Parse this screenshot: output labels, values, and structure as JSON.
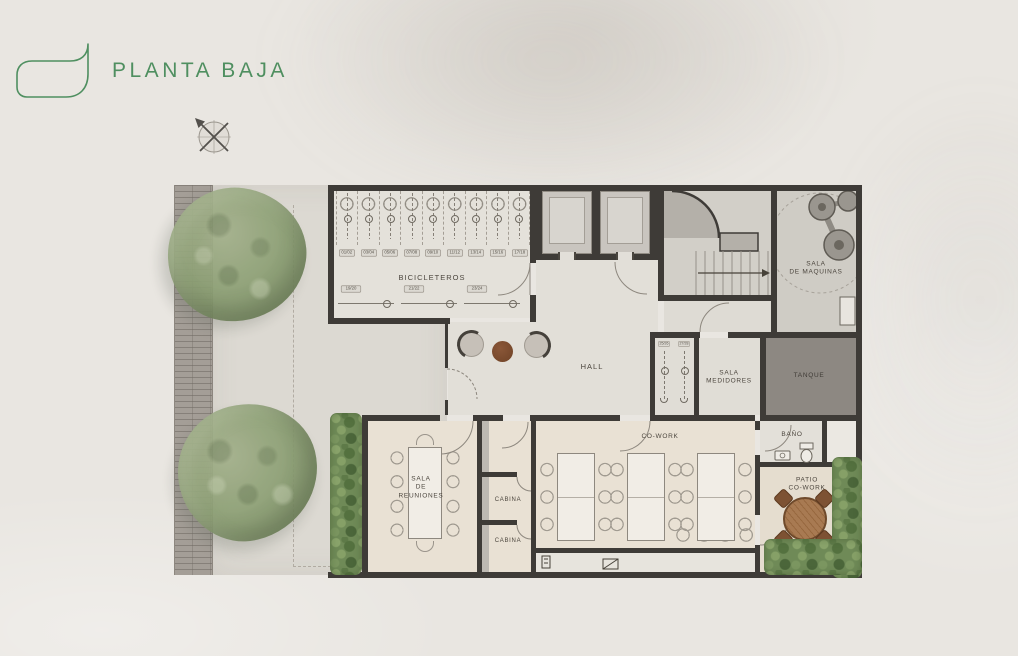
{
  "header": {
    "title": "PLANTA BAJA"
  },
  "plan": {
    "labels": {
      "bicicleteros": "BICICLETEROS",
      "hall": "HALL",
      "sala_maquinas": [
        "SALA",
        "DE MAQUINAS"
      ],
      "sala_medidores": [
        "SALA",
        "MEDIDORES"
      ],
      "tanque": "TANQUE",
      "cowork": "CO-WORK",
      "sala_reuniones": [
        "SALA",
        "DE",
        "REUNIONES"
      ],
      "cabina_1": "CABINA",
      "cabina_2": "CABINA",
      "banio": "BAÑO",
      "patio": [
        "PATIO",
        "CO-WORK"
      ]
    },
    "bike_spots": {
      "top_row": [
        "01/02",
        "03/04",
        "05/06",
        "07/08",
        "09/10",
        "11/12",
        "13/14",
        "15/16",
        "17/18"
      ],
      "bottom_row": [
        "19/20",
        "21/22",
        "23/24"
      ],
      "annex": [
        "25/26",
        "27/28"
      ]
    }
  },
  "theme": {
    "accent": "#4f8f60",
    "wall": "#3e3b37",
    "ink": "#4c463e",
    "floor": "#e2dfd8",
    "floor-warm": "#e9e1d4",
    "tanque": "#8d8882",
    "pave": "#a49e97",
    "concrete": "#dcd9d2",
    "tree": "#8da075",
    "hedge": "#6f8a57",
    "wood": "#a0734d"
  }
}
